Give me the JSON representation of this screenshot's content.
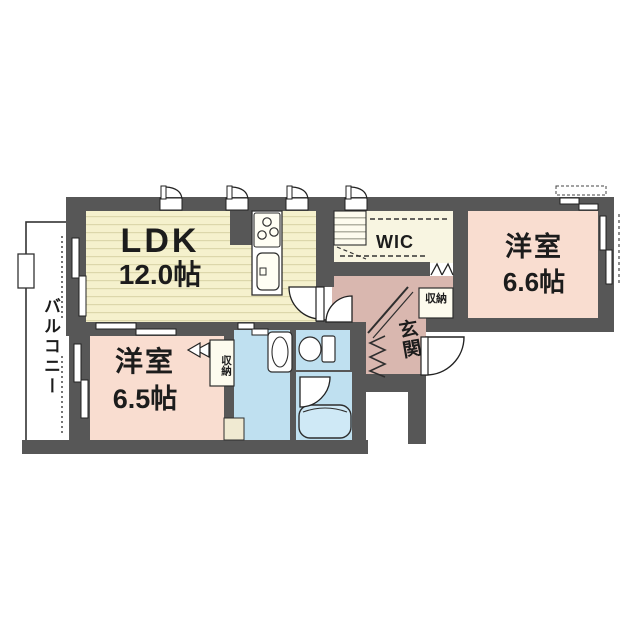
{
  "floor_plan": {
    "rooms": {
      "ldk": {
        "label": "LDK",
        "size": "12.0帖"
      },
      "wic": {
        "label": "WIC"
      },
      "bedroom_right": {
        "label": "洋室",
        "size": "6.6帖"
      },
      "bedroom_left": {
        "label": "洋室",
        "size": "6.5帖"
      },
      "entrance": {
        "label": "玄関"
      },
      "balcony": {
        "label": "バルコニー"
      },
      "storage_entrance": {
        "label": "収納"
      },
      "storage_bedroom": {
        "label": "収納"
      }
    },
    "colors": {
      "wall": "#575757",
      "ldk_floor": "#f5f1cd",
      "bedroom_floor": "#f9ddd0",
      "hall_floor": "#d9b7af",
      "wet_area_floor": "#bfe0f0",
      "wic_floor": "#f8f5e1"
    }
  }
}
